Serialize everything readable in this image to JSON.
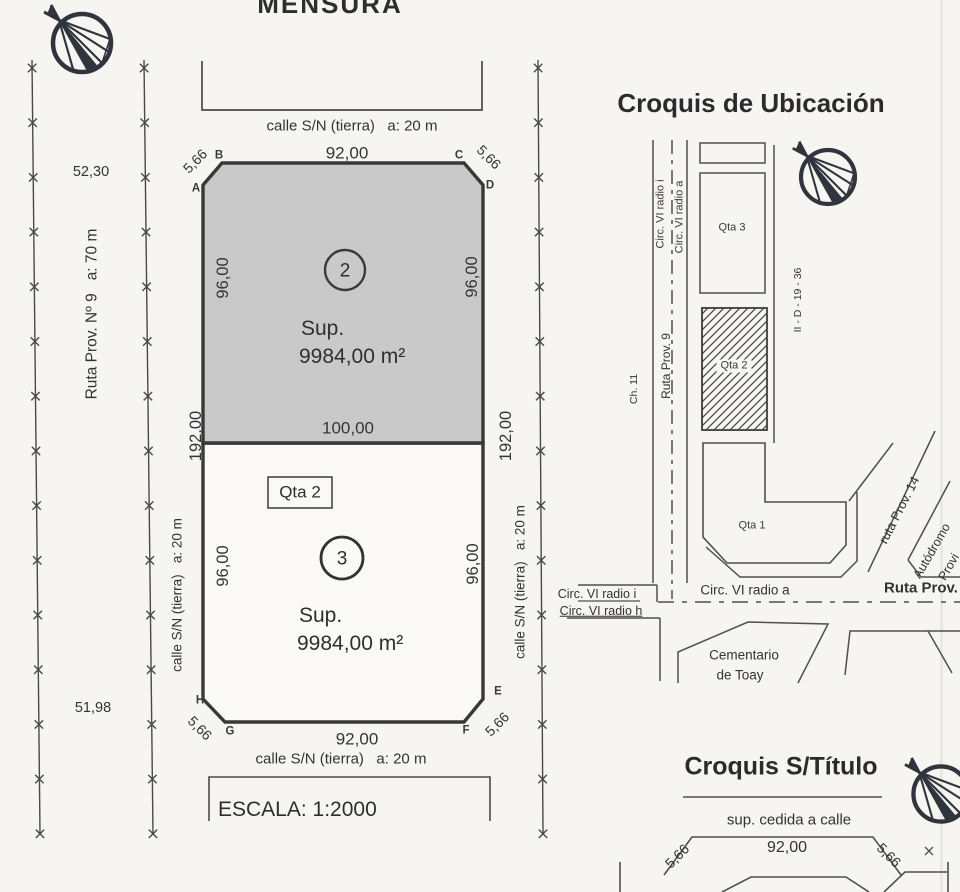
{
  "title": "MENSURA",
  "main_plot": {
    "street_top": "calle S/N (tierra)   a: 20 m",
    "width_top": "92,00",
    "street_bottom": "calle S/N (tierra)   a: 20 m",
    "width_bottom": "92,00",
    "width_middle": "100,00",
    "side_left_total": "192,00",
    "side_right_total": "192,00",
    "route_left": "Ruta Prov. Nº 9   a: 70 m",
    "street_left": "calle S/N (tierra)   a: 20 m",
    "street_right": "calle S/N (tierra)   a: 20 m",
    "dist_north": "52,30",
    "dist_south": "51,98",
    "block_label": "Qta 2",
    "scale": "ESCALA: 1:2000",
    "corners": {
      "a": "A",
      "b": "B",
      "c": "C",
      "d": "D",
      "e": "E",
      "f": "F",
      "g": "G",
      "h": "H"
    },
    "chamfer_top_left": "5,66",
    "chamfer_top_right": "5,66",
    "chamfer_bottom_left": "5,66",
    "chamfer_bottom_right": "5,66",
    "parcel2": {
      "number": "2",
      "sup_label": "Sup.",
      "area": "9984,00 m²",
      "side_left": "96,00",
      "side_right": "96,00"
    },
    "parcel3": {
      "number": "3",
      "sup_label": "Sup.",
      "area": "9984,00 m²",
      "side_left": "96,00",
      "side_right": "96,00"
    }
  },
  "croquis_ubicacion": {
    "title": "Croquis de Ubicación",
    "road_circ_i_v": "Circ. VI radio i",
    "road_circ_a_v": "Circ. VI radio a",
    "road_ruta9": "Ruta Prov. 9",
    "road_ch11": "Ch. 11",
    "cadastral_code": "II - D - 19 - 36",
    "block_qta3": "Qta 3",
    "block_qta2": "Qta 2",
    "block_qta1": "Qta 1",
    "road_circ_a_h": "Circ. VI radio a",
    "road_ruta_prov": "Ruta Prov.",
    "road_circ_i_left": "Circ. VI radio i",
    "road_circ_h_left": "Circ. VI radio h",
    "cementerio_line1": "Cementario",
    "cementerio_line2": "de Toay",
    "road_ruta14": "ruta Prov. 14",
    "road_autodromo_line1": "Autódromo",
    "road_autodromo_line2": "Provi"
  },
  "croquis_titulo": {
    "title": "Croquis S/Título",
    "subtitle": "sup. cedida a calle",
    "width": "92,00",
    "chamfer_left": "5,66",
    "chamfer_right": "5,66"
  }
}
